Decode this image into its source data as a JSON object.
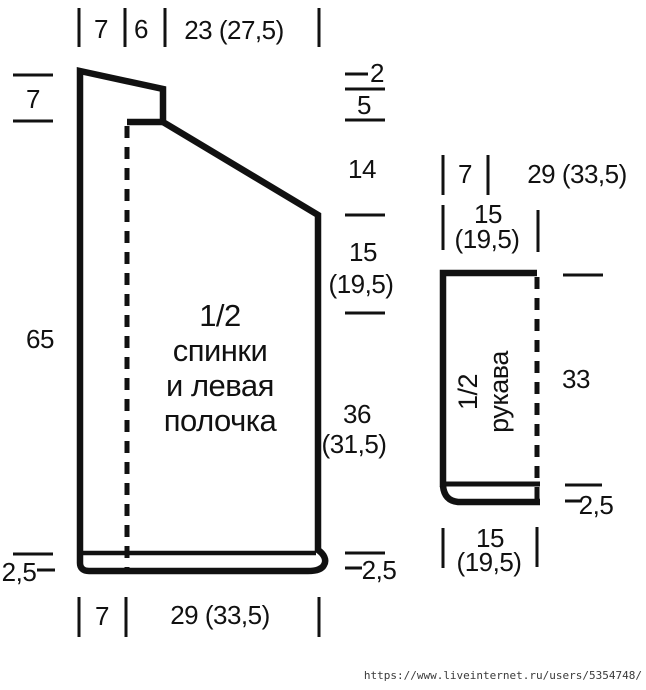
{
  "colors": {
    "ink": "#111111",
    "background": "#ffffff"
  },
  "main_piece": {
    "title_lines": [
      "1/2",
      "спинки",
      "и левая",
      "полочка"
    ],
    "measurements": {
      "top_band": "7",
      "top_neck": "6",
      "top_shoulder": "23 (27,5)",
      "left_shoulder_drop": "7",
      "left_length": "65",
      "left_hem": "2,5",
      "right_neck_step_width": "2",
      "right_neck_step_height": "5",
      "right_slope_height": "14",
      "right_armhole": "15",
      "right_armhole_alt": "(19,5)",
      "right_side": "36",
      "right_side_alt": "(31,5)",
      "right_hem": "2,5",
      "bottom_band": "7",
      "bottom_width": "29 (33,5)"
    }
  },
  "sleeve": {
    "title_lines": [
      "1/2",
      "рукава"
    ],
    "measurements": {
      "top_inset": "7",
      "top_width": "29 (33,5)",
      "upper_width": "15",
      "upper_width_alt": "(19,5)",
      "right_length": "33",
      "right_cuff": "2,5",
      "bottom_width": "15",
      "bottom_width_alt": "(19,5)"
    }
  },
  "footer": {
    "source_url": "https://www.liveinternet.ru/users/5354748/"
  }
}
